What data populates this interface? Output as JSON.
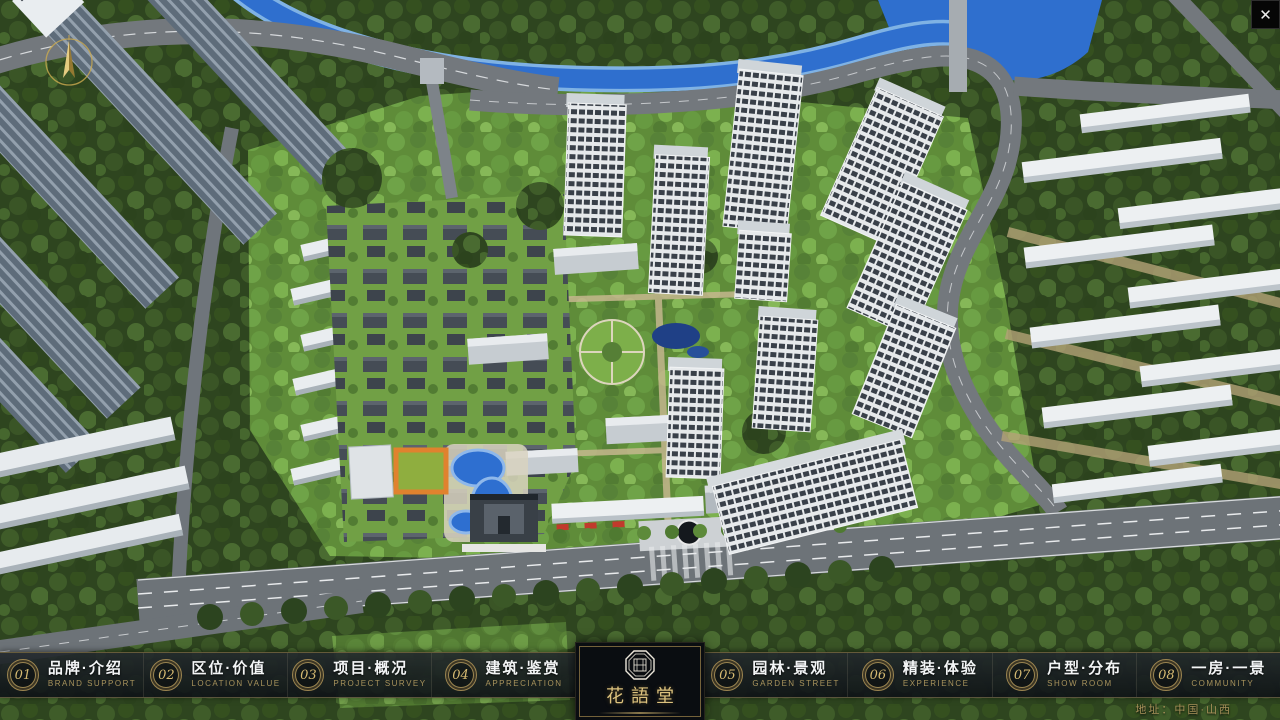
{
  "window": {
    "close_label": "✕"
  },
  "logo": {
    "title": "花語堂"
  },
  "nav": {
    "items": [
      {
        "num": "01",
        "label": "品牌·介绍",
        "caption": "BRAND SUPPORT"
      },
      {
        "num": "02",
        "label": "区位·价值",
        "caption": "LOCATION VALUE"
      },
      {
        "num": "03",
        "label": "项目·概况",
        "caption": "PROJECT SURVEY"
      },
      {
        "num": "04",
        "label": "建筑·鉴赏",
        "caption": "APPRECIATION"
      },
      {
        "num": "05",
        "label": "园林·景观",
        "caption": "GARDEN STREET"
      },
      {
        "num": "06",
        "label": "精装·体验",
        "caption": "EXPERIENCE"
      },
      {
        "num": "07",
        "label": "户型·分布",
        "caption": "SHOW ROOM"
      },
      {
        "num": "08",
        "label": "一房·一景",
        "caption": "COMMUNITY"
      }
    ]
  },
  "footer": {
    "address": "地址：中国·山西"
  },
  "scene_colors": {
    "water": "#2f6fce",
    "forest": "#2e451f",
    "grass": "#5f8c39",
    "road": "#73787d",
    "tower_frame": "#e6e9eb",
    "gold_accent": "#bfa562"
  }
}
